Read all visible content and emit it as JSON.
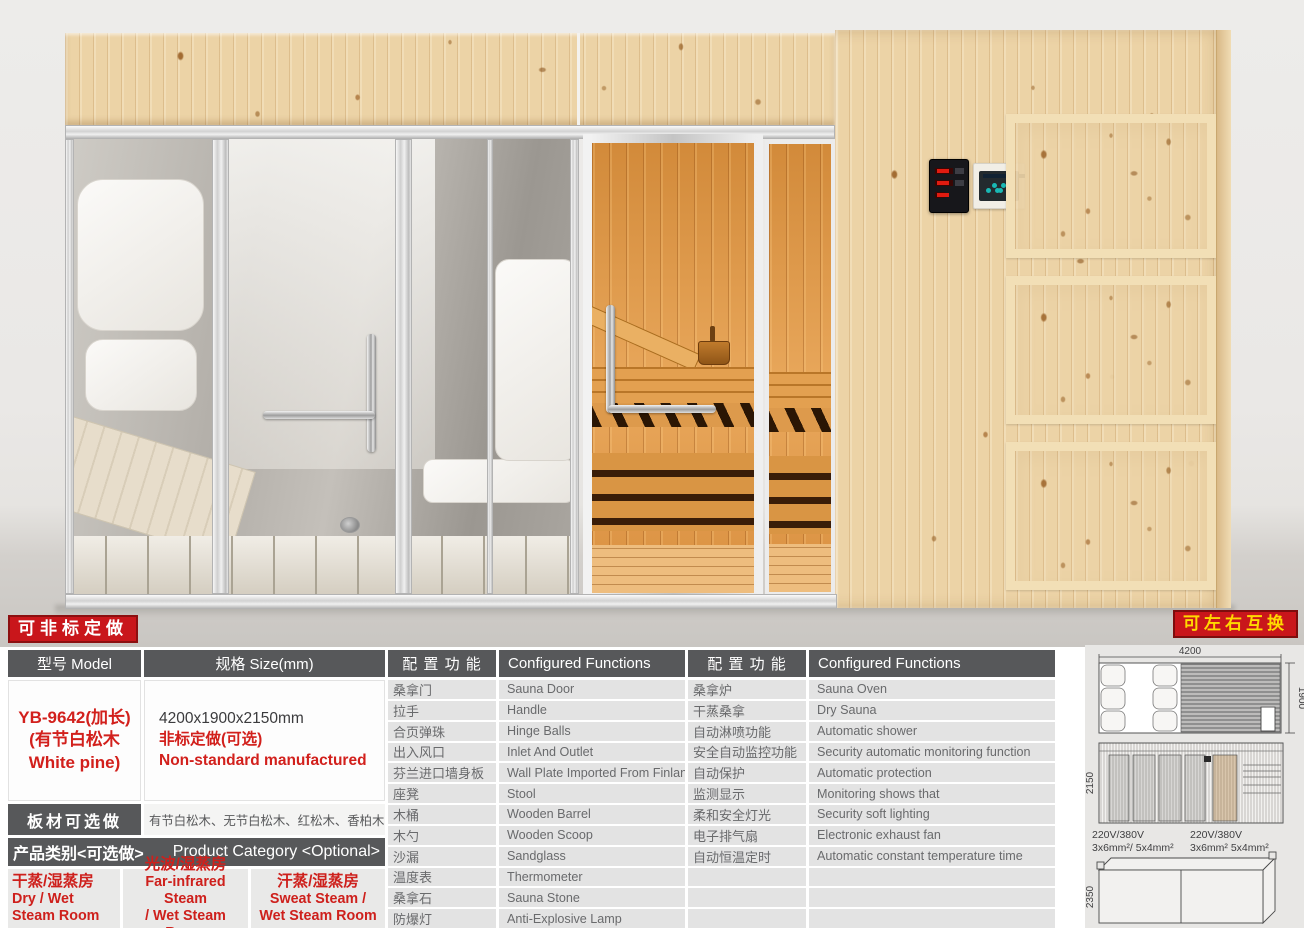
{
  "badges": {
    "customizable": "可非标定做",
    "swappable": "可左右互换"
  },
  "colors": {
    "badge_red": "#c9161b",
    "badge_yellow": "#ffd900",
    "header_gray": "#57585a",
    "row_gray": "#e3e3e3",
    "accent_red": "#d2201c",
    "wood": "#ecd3a6",
    "sauna_wood": "#dd9344"
  },
  "spec_table": {
    "model_header": "型号 Model",
    "size_header": "规格 Size(mm)",
    "model_line1": "YB-9642(加长)",
    "model_line2": "(有节白松木",
    "model_line3": "White pine)",
    "size_value": "4200x1900x2150mm",
    "size_note_cn": "非标定做(可选)",
    "size_note_en": "Non-standard manufactured",
    "functions_header_cn": "配 置 功 能",
    "functions_header_en": "Configured Functions",
    "functions_left": [
      {
        "cn": "桑拿门",
        "en": "Sauna Door"
      },
      {
        "cn": "拉手",
        "en": "Handle"
      },
      {
        "cn": "合页弹珠",
        "en": "Hinge Balls"
      },
      {
        "cn": "出入风口",
        "en": "Inlet And Outlet"
      },
      {
        "cn": "芬兰进口墙身板",
        "en": "Wall Plate Imported From Finland"
      },
      {
        "cn": "座凳",
        "en": "Stool"
      },
      {
        "cn": "木桶",
        "en": "Wooden Barrel"
      },
      {
        "cn": "木勺",
        "en": "Wooden Scoop"
      },
      {
        "cn": "沙漏",
        "en": "Sandglass"
      },
      {
        "cn": "温度表",
        "en": "Thermometer"
      },
      {
        "cn": "桑拿石",
        "en": "Sauna Stone"
      },
      {
        "cn": "防爆灯",
        "en": "Anti-Explosive Lamp"
      }
    ],
    "functions_right": [
      {
        "cn": "桑拿炉",
        "en": "Sauna Oven"
      },
      {
        "cn": "干蒸桑拿",
        "en": "Dry Sauna"
      },
      {
        "cn": "自动淋喷功能",
        "en": "Automatic shower"
      },
      {
        "cn": "安全自动监控功能",
        "en": "Security automatic monitoring function"
      },
      {
        "cn": "自动保护",
        "en": "Automatic protection"
      },
      {
        "cn": "监测显示",
        "en": "Monitoring shows that"
      },
      {
        "cn": "柔和安全灯光",
        "en": "Security soft lighting"
      },
      {
        "cn": "电子排气扇",
        "en": "Electronic exhaust fan"
      },
      {
        "cn": "自动恒温定时",
        "en": "Automatic constant temperature time"
      },
      {
        "cn": "",
        "en": ""
      },
      {
        "cn": "",
        "en": ""
      },
      {
        "cn": "",
        "en": ""
      }
    ],
    "board_header": "板材可选做",
    "board_options": "有节白松木、无节白松木、红松木、香柏木",
    "category_header_cn": "产品类别<可选做>",
    "category_header_en": "Product Category <Optional>",
    "categories": [
      {
        "cn": "干蒸/湿蒸房",
        "en1": "Dry / Wet",
        "en2": "Steam Room"
      },
      {
        "cn": "光波/湿蒸房",
        "en1": "Far-infrared Steam",
        "en2": "/ Wet Steam Room"
      },
      {
        "cn": "汗蒸/湿蒸房",
        "en1": "Sweat Steam /",
        "en2": "Wet Steam Room"
      }
    ]
  },
  "diagrams": {
    "plan_width": "4200",
    "plan_depth": "1900",
    "elevation_height": "2150",
    "package_height": "2350",
    "power_left_1": "220V/380V",
    "power_left_2": "3x6mm²/ 5x4mm²",
    "power_right_1": "220V/380V",
    "power_right_2": "3x6mm² 5x4mm²"
  }
}
